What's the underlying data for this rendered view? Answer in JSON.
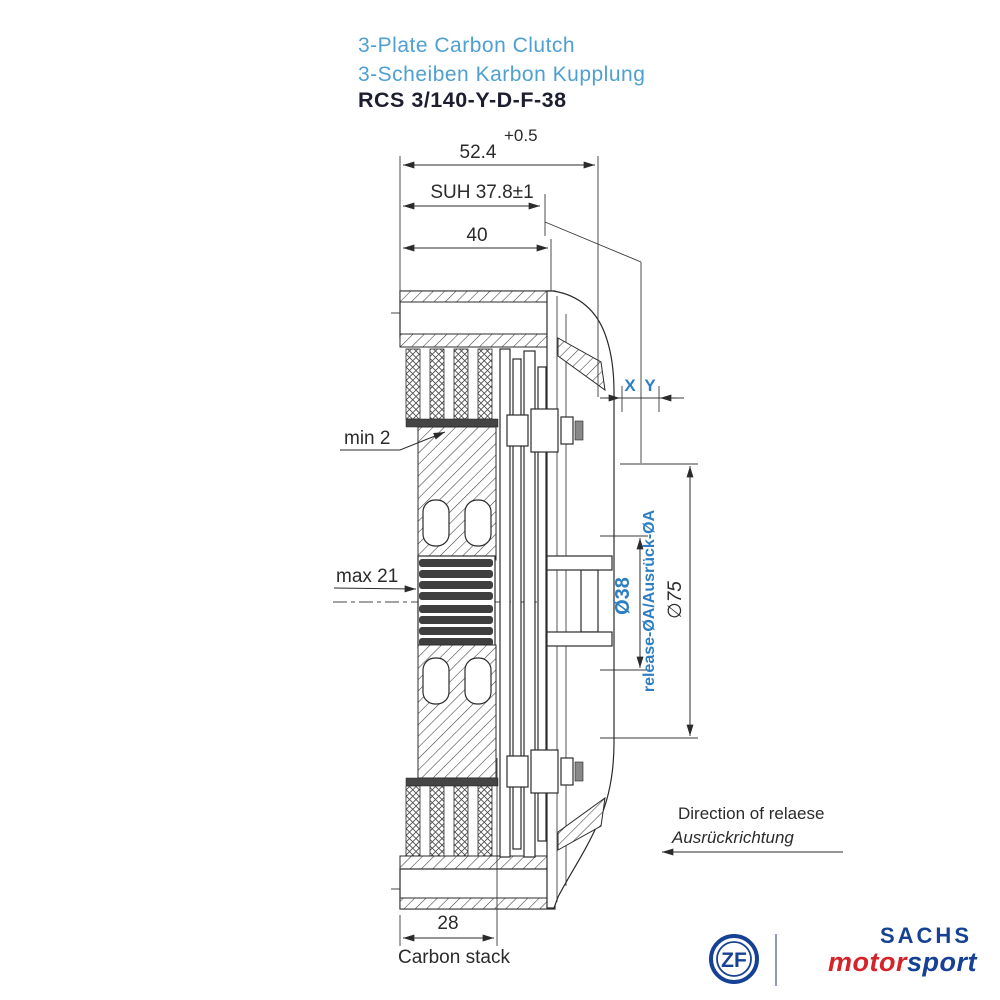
{
  "title": {
    "product_en": "3-Plate Carbon Clutch",
    "product_de": "3-Scheiben Karbon Kupplung",
    "model": "RCS 3/140-Y-D-F-38"
  },
  "dimensions": {
    "tolerance_top": "+0.5",
    "overall_width": "52.4",
    "suh": "SUH 37.8±1",
    "cover_depth": "40",
    "min_wear": "min 2",
    "max_wear": "max 21",
    "x": "X",
    "y": "Y",
    "release_diameter": "Ø38",
    "release_diameter_note": "release-ØA/Ausrück-ØA",
    "outer_diameter": "∅75",
    "carbon_stack_width": "28",
    "carbon_stack_label": "Carbon stack",
    "release_direction_en": "Direction of relaese",
    "release_direction_de": "Ausrückrichtung"
  },
  "branding": {
    "zf_monogram": "ZF",
    "brand": "SACHS",
    "series_red": "motor",
    "series_blue": "sport"
  },
  "colors": {
    "title_blue": "#4FA0D2",
    "annotation_blue": "#2E7EC1",
    "drawing_line": "#2b2b2b",
    "zf_blue": "#164194",
    "motorsport_red": "#D5232A"
  }
}
